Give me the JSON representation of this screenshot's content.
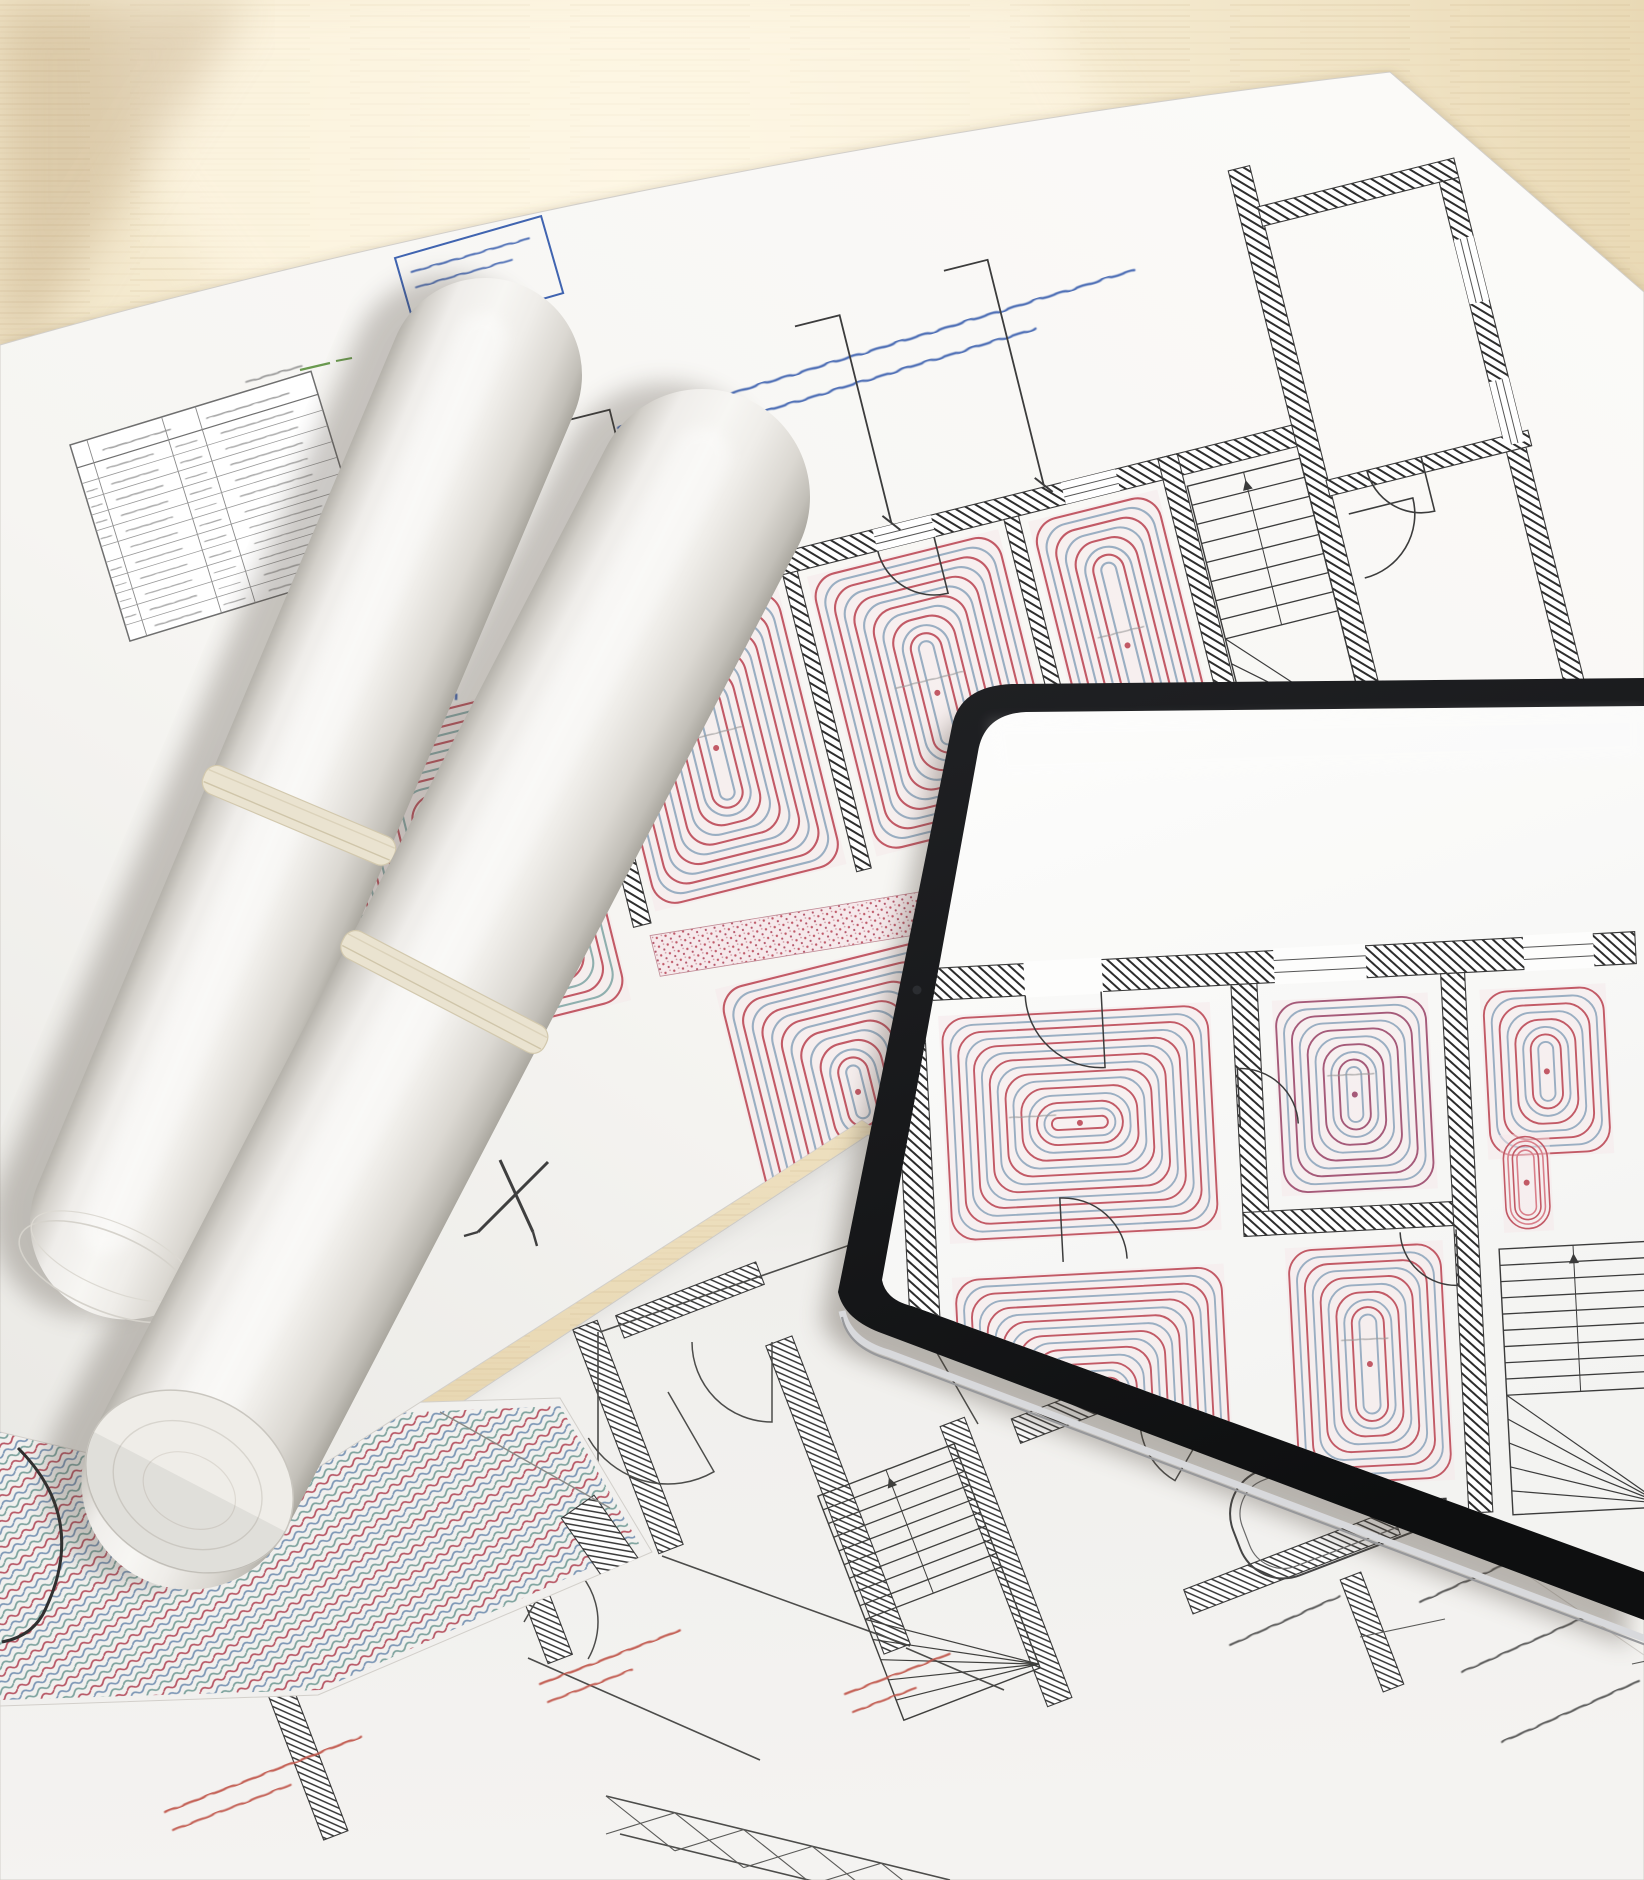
{
  "scene": {
    "title": "Architectural underfloor-heating blueprints on a wooden desk with two rolled plans and a tablet",
    "kind": "photograph"
  },
  "colors": {
    "wood_light": "#fdf6e3",
    "wood_mid": "#f0e3c4",
    "wood_deep": "#e2cfa6",
    "wood_shadow": "#d5bd92",
    "paper_main": "#f6f5f2",
    "paper_main_shade": "#e9e8e4",
    "paper_bottom": "#f0efec",
    "paper_coil": "#f1f0ee",
    "paper_corner": "#f3f2ef",
    "edge_grey": "#d2cfca",
    "line_black": "#3b3b3b",
    "hatch_black": "#2d2d2d",
    "coil_red": "#c25a66",
    "coil_pink": "#dd9aa4",
    "coil_blue": "#9aaec2",
    "coil_teal": "#8fafae",
    "coil_purple": "#a55a79",
    "room_wash": "#f5e7e9",
    "annotation_blue": "#4064b0",
    "annotation_red": "#b63c30",
    "annotation_green": "#6a9a4f",
    "table_grey": "#8b8b8b",
    "label_red": "#c0554a",
    "note_black": "#4a4a48",
    "stamp_blue": "#4a6fae",
    "tablet_bezel_a": "#202124",
    "tablet_bezel_b": "#0e0f10",
    "tablet_edge": "#d8d9dc",
    "tablet_edge_dark": "#97989b",
    "screen_white": "#fdfdfc",
    "roll_dark": "#aaa79f",
    "roll_mid": "#dbd8d2",
    "roll_light": "#f7f6f3",
    "cord_cream": "#eae3d0",
    "cord_edge": "#d2c8ad",
    "shadow_warm": "#7c6742",
    "shadow_cool": "#4a4136"
  },
  "sheets": {
    "main": "M0,345 C380,236 900,128 1390,72 L1644,292 L1644,1655 L862,1120 L272,1497 L0,1432 Z",
    "bottom": "M0,1685 L295,1512 L868,1135 L1644,1640 L1644,1880 L0,1880 Z",
    "corner": "M960,1880 L1480,1745 L1644,1850 L1644,1880 Z",
    "coil_poly": "M0,1415 L560,1398 L652,1552 L318,1695 L0,1706 Z",
    "coil_curve": "M18,1448 q70,70 28,160 q-12,28 -44,34"
  },
  "legend_table": {
    "x": 70,
    "y": 445,
    "w": 252,
    "h": 205,
    "rotate": -17,
    "header_h": 24,
    "rows": 11,
    "cols": [
      0.07,
      0.31,
      0.14,
      0.48
    ]
  },
  "title_box": {
    "x": 395,
    "y": 258,
    "w": 152,
    "h": 80,
    "rotate": -16,
    "lines": 2
  },
  "blue_note": {
    "x": 618,
    "y": 428,
    "rotate": -17,
    "lines": [
      540,
      430,
      120
    ]
  },
  "leaders": {
    "red": [
      451,
      342,
      436,
      718
    ],
    "blue_dash": [
      472,
      344,
      456,
      700
    ]
  },
  "green_tick": {
    "x": 300,
    "y": 370
  },
  "grey_note": {
    "x": 246,
    "y": 382,
    "len": 58,
    "rotate": -16
  },
  "cross_mark": {
    "x": 515,
    "y": 1197
  },
  "main_plan": {
    "rotate": -14,
    "cx": 430,
    "cy": 640,
    "top_wall": [
      560,
      640,
      775,
      22
    ],
    "walls": [
      [
        558,
        662,
        18,
        306
      ],
      [
        788,
        662,
        15,
        306
      ],
      [
        1016,
        662,
        15,
        306
      ],
      [
        1180,
        640,
        20,
        330
      ],
      [
        1318,
        378,
        22,
        614
      ],
      [
        1338,
        420,
        202,
        20
      ],
      [
        1520,
        440,
        20,
        550
      ],
      [
        1338,
        702,
        208,
        16
      ],
      [
        238,
        678,
        30,
        376
      ],
      [
        1196,
        954,
        126,
        16
      ]
    ],
    "windows": [
      [
        648,
        640,
        64,
        22
      ],
      [
        886,
        640,
        60,
        22
      ],
      [
        1080,
        640,
        56,
        22
      ],
      [
        1520,
        500,
        20,
        66
      ],
      [
        1520,
        646,
        20,
        66
      ]
    ],
    "coil_rooms": [
      [
        583,
        670,
        197,
        288,
        0
      ],
      [
        811,
        670,
        197,
        288,
        0
      ],
      [
        1039,
        670,
        133,
        288,
        0
      ],
      [
        286,
        708,
        252,
        330,
        1
      ],
      [
        622,
        1048,
        228,
        268,
        0
      ],
      [
        872,
        1064,
        228,
        282,
        0
      ],
      [
        1122,
        1082,
        232,
        292,
        0
      ]
    ],
    "speckle": [
      [
        572,
        980
      ],
      [
        1190,
        1032
      ],
      [
        1190,
        1074
      ],
      [
        572,
        1022
      ]
    ],
    "stairs": {
      "x": 1202,
      "y": 674,
      "w": 116,
      "h": 286,
      "steps": 8
    },
    "dims": [
      [
        660,
        638,
        660,
        460,
        616,
        460
      ],
      [
        906,
        638,
        906,
        424,
        860,
        424
      ],
      [
        1063,
        638,
        1063,
        406,
        1018,
        406
      ]
    ],
    "arcs": [
      [
        712,
        662,
        62,
        90,
        180
      ],
      [
        944,
        662,
        58,
        90,
        180
      ],
      [
        1352,
        740,
        66,
        0,
        90
      ],
      [
        1436,
        702,
        56,
        90,
        180
      ]
    ]
  },
  "rolls": [
    {
      "cx": 485,
      "cy": 375,
      "r": 97,
      "len": 920,
      "angle": 22.9,
      "cord_y": 838,
      "end": "cap"
    },
    {
      "cx": 702,
      "cy": 497,
      "r": 108,
      "len": 1110,
      "angle": 27.5,
      "cord_y": 1040,
      "end": "face"
    }
  ],
  "tablet": {
    "outer": "M838,1292 L952,726 Q960,686 1012,684 L1644,678 L1644,1620 L884,1334 Q844,1320 838,1292 Z",
    "screen": "M882,1280 L978,752 Q984,714 1026,712 L1644,706 L1644,1572 L912,1306 Q886,1300 882,1280 Z",
    "camera": [
      917,
      990
    ],
    "edge": "M840,1302 Q846,1332 886,1344 L1644,1630",
    "plan": {
      "rotate": -3,
      "cx": 1250,
      "cy": 1120,
      "walls": [
        [
          900,
          952,
          744,
          32
        ],
        [
          900,
          952,
          30,
          586
        ],
        [
          1238,
          984,
          26,
          252
        ],
        [
          1238,
          1212,
          232,
          24
        ],
        [
          1448,
          984,
          24,
          540
        ],
        [
          932,
          1524,
          304,
          28
        ],
        [
          1246,
          1508,
          180,
          26
        ]
      ],
      "gaps": [
        [
          1032,
          950,
          78,
          36
        ],
        [
          1282,
          950,
          92,
          36
        ],
        [
          1532,
          950,
          70,
          36
        ]
      ],
      "rooms": [
        [
          944,
          1000,
          272,
          228,
          0
        ],
        [
          944,
          1262,
          272,
          240,
          0
        ],
        [
          1278,
          1002,
          156,
          196,
          2
        ],
        [
          1278,
          1250,
          158,
          240,
          0
        ],
        [
          1486,
          1002,
          126,
          170,
          0
        ]
      ],
      "red_strip": [
        1498,
        1148,
        50,
        98
      ],
      "stairs": {
        "x": 1492,
        "y": 1262,
        "w": 148,
        "h": 266,
        "steps": 9
      },
      "arcs": [
        [
          1108,
          984,
          76,
          90,
          180
        ],
        [
          1056,
          1252,
          64,
          270,
          360
        ],
        [
          1240,
          1126,
          58,
          270,
          360
        ],
        [
          1450,
          1240,
          56,
          90,
          180
        ]
      ],
      "labels": [
        [
          1010,
          1105
        ],
        [
          1010,
          1368
        ],
        [
          1330,
          1080
        ],
        [
          1330,
          1345
        ]
      ]
    }
  },
  "bottom_plan": {
    "rotate": -21,
    "hatch_walls": [
      [
        628,
        1437,
        26,
        240
      ],
      [
        528,
        1575,
        26,
        180
      ],
      [
        690,
        1300,
        150,
        24
      ],
      [
        962,
        1206,
        120,
        24
      ],
      [
        838,
        1495,
        28,
        330
      ],
      [
        1006,
        1562,
        26,
        300
      ],
      [
        1170,
        1372,
        330,
        26
      ],
      [
        1292,
        1562,
        222,
        26
      ],
      [
        1345,
        1205,
        24,
        170
      ],
      [
        1052,
        1220,
        24,
        150
      ],
      [
        1372,
        1632,
        22,
        120
      ],
      [
        300,
        1742,
        26,
        200
      ],
      [
        408,
        1560,
        24,
        150
      ]
    ],
    "extra_lines": [
      [
        598,
        1332,
        598,
        1565
      ],
      [
        600,
        1332,
        1008,
        1190
      ],
      [
        1008,
        1190,
        1352,
        1312
      ],
      [
        662,
        1556,
        910,
        1646
      ],
      [
        528,
        1658,
        760,
        1760
      ],
      [
        906,
        1648,
        1004,
        1690
      ],
      [
        1356,
        1292,
        1640,
        1400
      ]
    ],
    "stairs": {
      "x": 856,
      "y": 1462,
      "w": 146,
      "h": 240,
      "steps": 9
    },
    "tub": [
      1345,
      1498,
      232,
      112
    ],
    "sinks": [
      [
        450,
        1506,
        82,
        54
      ],
      [
        345,
        1284,
        92,
        62
      ]
    ],
    "basins": [
      [
        1142,
        1270,
        40
      ],
      [
        1224,
        1234,
        30
      ]
    ],
    "small_rects": [
      [
        1262,
        1342,
        58,
        40
      ],
      [
        1180,
        1330,
        44,
        36
      ]
    ],
    "arcs": [
      [
        668,
        1392,
        92,
        60,
        150
      ],
      [
        772,
        1342,
        80,
        90,
        180
      ],
      [
        978,
        1424,
        84,
        240,
        330
      ],
      [
        524,
        1622,
        74,
        300,
        390
      ],
      [
        1210,
        1420,
        70,
        120,
        210
      ]
    ],
    "labels_red": [
      [
        400,
        1458,
        72,
        1
      ],
      [
        540,
        1684,
        150,
        2
      ],
      [
        845,
        1694,
        112,
        2
      ],
      [
        165,
        1812,
        210,
        2
      ]
    ],
    "labels_black": [
      [
        1230,
        1645,
        120
      ],
      [
        1420,
        1602,
        150
      ],
      [
        1462,
        1672,
        160
      ],
      [
        1502,
        1742,
        150
      ]
    ],
    "stamp": [
      737,
      1152,
      48,
      42
    ],
    "brace": [
      [
        606,
        1796
      ],
      [
        950,
        1880
      ]
    ]
  }
}
